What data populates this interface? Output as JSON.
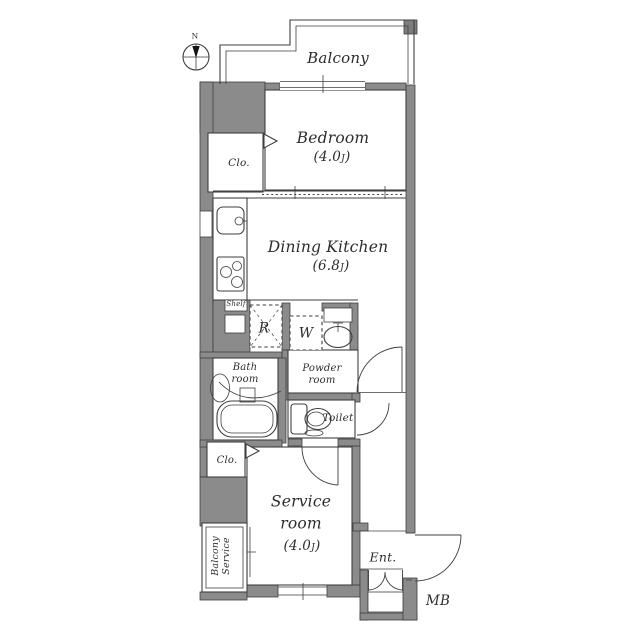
{
  "compass": {
    "north": "N"
  },
  "rooms": {
    "balcony": {
      "name": "Balcony"
    },
    "bedroom": {
      "name": "Bedroom",
      "area_pre": "(4.0",
      "area_unit": "J",
      "area_post": ")"
    },
    "closet_upper": {
      "name": "Clo."
    },
    "dining_kitchen": {
      "name": "Dining Kitchen",
      "area_pre": "(6.8",
      "area_unit": "J",
      "area_post": ")"
    },
    "shelf": {
      "name": "Shelf"
    },
    "refrigerator_space": {
      "name": "R"
    },
    "washer_space": {
      "name": "W"
    },
    "bath_room": {
      "line1": "Bath",
      "line2": "room"
    },
    "powder_room": {
      "line1": "Powder",
      "line2": "room"
    },
    "toilet": {
      "name": "Toilet"
    },
    "closet_lower": {
      "name": "Clo."
    },
    "service_room": {
      "line1": "Service",
      "line2": "room",
      "area_pre": "(4.0",
      "area_unit": "J",
      "area_post": ")"
    },
    "service_balcony": {
      "line1": "Service",
      "line2": "Balcony"
    },
    "entrance": {
      "name": "Ent."
    },
    "meter_box": {
      "name": "MB"
    }
  },
  "colors": {
    "wall_fill": "#8b8b8b",
    "line": "#3f3f3f",
    "background": "#ffffff"
  }
}
